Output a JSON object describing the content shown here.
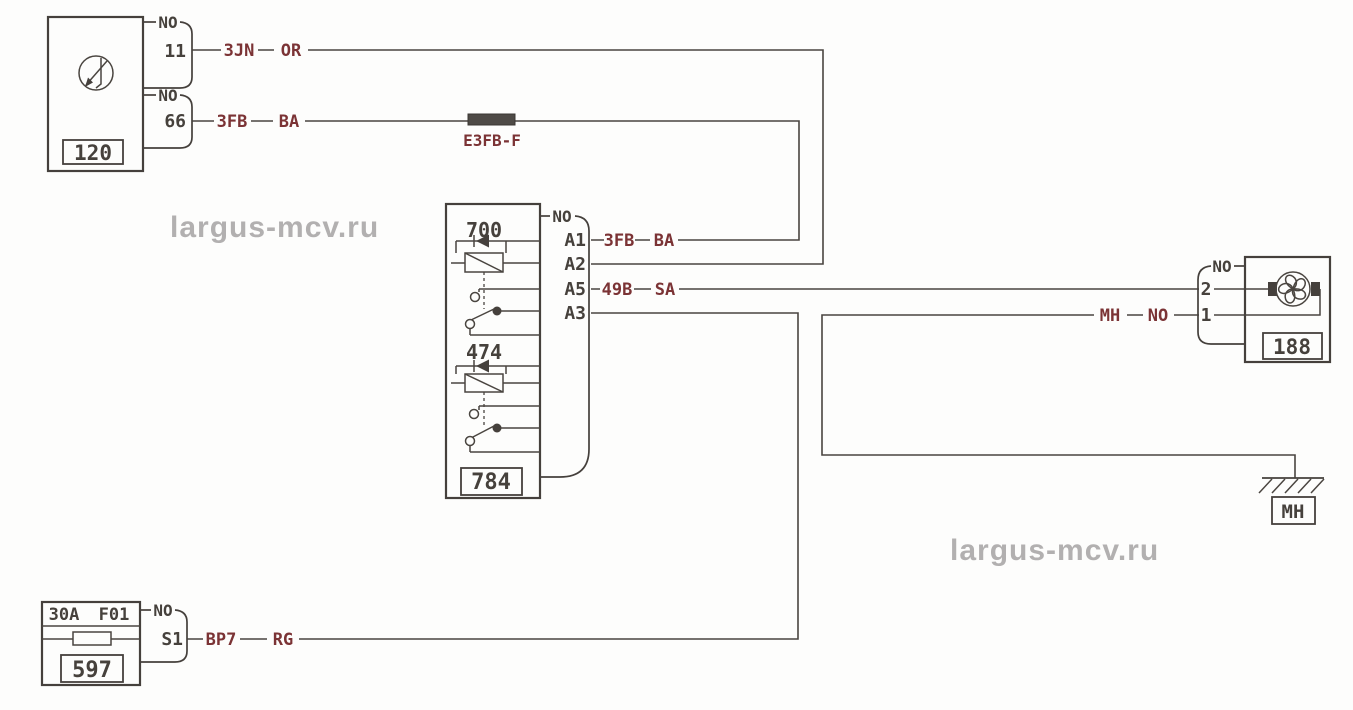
{
  "diagram": {
    "watermark": "largus-mcv.ru",
    "components": {
      "control_unit": {
        "id": "120",
        "pins": [
          {
            "connector": "NO",
            "pin": "11"
          },
          {
            "connector": "NO",
            "pin": "66"
          }
        ]
      },
      "relay_module": {
        "id": "784",
        "connector_label": "NO",
        "relay_top": "700",
        "relay_bottom": "474",
        "pins": [
          "A1",
          "A2",
          "A5",
          "A3"
        ]
      },
      "fan_motor": {
        "id": "188",
        "connector_label": "NO",
        "pins": [
          "2",
          "1"
        ]
      },
      "fuse": {
        "id": "597",
        "rating": "30A",
        "name": "F01",
        "connector_label": "NO",
        "pin": "S1"
      },
      "ground": {
        "id": "MH"
      }
    },
    "wires": {
      "w_3jn": {
        "code": "3JN",
        "color": "OR"
      },
      "w_3fb_top": {
        "code": "3FB",
        "color": "BA"
      },
      "splice": {
        "id": "E3FB-F"
      },
      "w_3fb_a1": {
        "code": "3FB",
        "color": "BA"
      },
      "w_49b": {
        "code": "49B",
        "color": "SA"
      },
      "w_mh": {
        "code": "MH",
        "color": "NO"
      },
      "w_bp7": {
        "code": "BP7",
        "color": "RG"
      }
    },
    "colors": {
      "line": "#4a4540",
      "wire_label": "#7b3335",
      "pin_label": "#46413c",
      "splice_fill": "#4e4a46",
      "watermark": "#b2b0b0",
      "background": "#fdfdfc"
    }
  }
}
